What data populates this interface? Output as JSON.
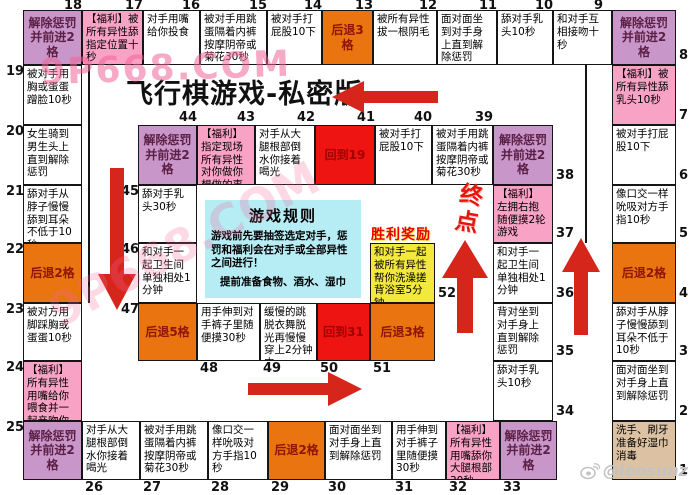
{
  "title": "飞行棋游戏-私密版",
  "labels": {
    "victory_header": "胜利奖励",
    "finish": "终点"
  },
  "rules": {
    "title": "游戏规则",
    "line1": "游戏前先要抽签选定对手，惩罚和福利会在对手或全部异性之间进行！",
    "line2": "提前准备食物、酒水、湿巾"
  },
  "watermarks": {
    "top": "9P668.COM",
    "diagonal": "9P668.COM",
    "credit": "@leosunz"
  },
  "colors": {
    "white": "#ffffff",
    "pink": "#f8a2c5",
    "purple": "#c996c9",
    "orange": "#e97410",
    "red": "#ee1411",
    "yellow": "#f3e93e",
    "tan": "#dcc2a2",
    "purple_text": "#5c2046",
    "orange_text": "#8f1500",
    "red_text": "#a30000",
    "black_text": "#000000",
    "border": "#151515",
    "rules_bg": "#b6ecf4",
    "arrow": "#d6261b",
    "victory_text": "#e60000",
    "finish_text": "#e8150f",
    "watermark_pink": "rgba(240,100,150,0.55)",
    "credit_gray": "#c3c3c3"
  },
  "board": {
    "cells": [
      {
        "num": 1,
        "text": "洗手、刷牙准备好湿巾消毒",
        "color": "tan",
        "x": 612,
        "y": 421,
        "w": 64,
        "h": 59,
        "numpos": "right"
      },
      {
        "num": 2,
        "text": "面对面坐到对手身上直到解除惩罚",
        "color": "white",
        "x": 612,
        "y": 361,
        "w": 64,
        "h": 60,
        "numpos": "right"
      },
      {
        "num": 3,
        "text": "舔对手从脖子慢慢舔到耳朵不低于10秒",
        "color": "white",
        "x": 612,
        "y": 303,
        "w": 64,
        "h": 58,
        "numpos": "right"
      },
      {
        "num": 4,
        "text": "后退2格",
        "color": "orange",
        "x": 612,
        "y": 243,
        "w": 64,
        "h": 60,
        "numpos": "right"
      },
      {
        "num": 5,
        "text": "像口交一样吮吸对方手指10秒",
        "color": "white",
        "x": 612,
        "y": 185,
        "w": 64,
        "h": 58,
        "numpos": "right"
      },
      {
        "num": 6,
        "text": "被对手打屁股10下",
        "color": "white",
        "x": 612,
        "y": 125,
        "w": 64,
        "h": 60,
        "numpos": "right"
      },
      {
        "num": 7,
        "text": "【福利】被所有异性舔乳头10秒",
        "color": "pink",
        "x": 612,
        "y": 65,
        "w": 64,
        "h": 60,
        "numpos": "right"
      },
      {
        "num": 8,
        "text": "解除惩罚并前进2格",
        "color": "purple",
        "x": 612,
        "y": 10,
        "w": 64,
        "h": 55,
        "numpos": "right"
      },
      {
        "num": 9,
        "text": "和对手互相接吻十秒",
        "color": "white",
        "x": 553,
        "y": 10,
        "w": 59,
        "h": 55,
        "numpos": "top"
      },
      {
        "num": 10,
        "text": "舔对手乳头10秒",
        "color": "white",
        "x": 497,
        "y": 10,
        "w": 56,
        "h": 55,
        "numpos": "top"
      },
      {
        "num": 11,
        "text": "面对面坐到对手身上直到解除惩罚",
        "color": "white",
        "x": 437,
        "y": 10,
        "w": 60,
        "h": 55,
        "numpos": "top"
      },
      {
        "num": 12,
        "text": "被所有异性拔一根阴毛",
        "color": "white",
        "x": 373,
        "y": 10,
        "w": 64,
        "h": 55,
        "numpos": "top"
      },
      {
        "num": 13,
        "text": "后退3格",
        "color": "orange",
        "x": 322,
        "y": 10,
        "w": 51,
        "h": 55,
        "numpos": "top"
      },
      {
        "num": 14,
        "text": "被对手打屁股10下",
        "color": "white",
        "x": 267,
        "y": 10,
        "w": 55,
        "h": 55,
        "numpos": "top"
      },
      {
        "num": 15,
        "text": "被对手用跳蛋隔着内裤按摩阴帝或菊花30秒",
        "color": "white",
        "x": 200,
        "y": 10,
        "w": 67,
        "h": 55,
        "numpos": "top"
      },
      {
        "num": 16,
        "text": "对手用嘴给你投食",
        "color": "white",
        "x": 143,
        "y": 10,
        "w": 57,
        "h": 55,
        "numpos": "top"
      },
      {
        "num": 17,
        "text": "【福利】被所有异性舔指定位置十秒",
        "color": "pink",
        "x": 82,
        "y": 10,
        "w": 61,
        "h": 55,
        "numpos": "top"
      },
      {
        "num": 18,
        "text": "解除惩罚并前进2格",
        "color": "purple",
        "x": 23,
        "y": 10,
        "w": 59,
        "h": 55,
        "numpos": "top"
      },
      {
        "num": 19,
        "text": "被对手用胸或蛋蛋蹭脸10秒",
        "color": "white",
        "x": 23,
        "y": 65,
        "w": 59,
        "h": 60,
        "numpos": "left"
      },
      {
        "num": 20,
        "text": "女生骑到男生头上直到解除惩罚",
        "color": "white",
        "x": 23,
        "y": 125,
        "w": 59,
        "h": 60,
        "numpos": "left"
      },
      {
        "num": 21,
        "text": "舔对手从脖子慢慢舔到耳朵不低于10秒",
        "color": "white",
        "x": 23,
        "y": 185,
        "w": 59,
        "h": 58,
        "numpos": "left"
      },
      {
        "num": 22,
        "text": "后退2格",
        "color": "orange",
        "x": 23,
        "y": 243,
        "w": 59,
        "h": 60,
        "numpos": "left"
      },
      {
        "num": 23,
        "text": "被对方用脚踩胸或蛋蛋10秒",
        "color": "white",
        "x": 23,
        "y": 303,
        "w": 59,
        "h": 58,
        "numpos": "left"
      },
      {
        "num": 24,
        "text": "【福利】所有异性用嘴给你喂食并一起亲吻你",
        "color": "pink",
        "x": 23,
        "y": 361,
        "w": 59,
        "h": 60,
        "numpos": "left"
      },
      {
        "num": 25,
        "text": "解除惩罚并前进2格",
        "color": "purple",
        "x": 23,
        "y": 421,
        "w": 59,
        "h": 59,
        "numpos": "left"
      },
      {
        "num": 26,
        "text": "对手从大腿根部倒水你接着喝光",
        "color": "white",
        "x": 82,
        "y": 421,
        "w": 58,
        "h": 59,
        "numpos": "bottom"
      },
      {
        "num": 27,
        "text": "被对手用跳蛋隔着内裤按摩阴帝或菊花30秒",
        "color": "white",
        "x": 140,
        "y": 421,
        "w": 68,
        "h": 59,
        "numpos": "bottom"
      },
      {
        "num": 28,
        "text": "像口交一样吮吸对方手指10秒",
        "color": "white",
        "x": 208,
        "y": 421,
        "w": 60,
        "h": 59,
        "numpos": "bottom"
      },
      {
        "num": 29,
        "text": "后退2格",
        "color": "orange",
        "x": 268,
        "y": 421,
        "w": 57,
        "h": 59,
        "numpos": "bottom"
      },
      {
        "num": 30,
        "text": "面对面坐到对手身上直到解除惩罚",
        "color": "white",
        "x": 325,
        "y": 421,
        "w": 67,
        "h": 59,
        "numpos": "bottom"
      },
      {
        "num": 31,
        "text": "用手伸到对手裤子里随便摸30秒",
        "color": "white",
        "x": 392,
        "y": 421,
        "w": 54,
        "h": 59,
        "numpos": "bottom"
      },
      {
        "num": 32,
        "text": "【福利】所有异性用嘴舔你大腿根部30秒",
        "color": "pink",
        "x": 446,
        "y": 421,
        "w": 54,
        "h": 59,
        "numpos": "bottom"
      },
      {
        "num": 33,
        "text": "解除惩罚并前进2格",
        "color": "purple",
        "x": 500,
        "y": 421,
        "w": 57,
        "h": 59,
        "numpos": "bottom"
      },
      {
        "num": 34,
        "text": "舔对手乳头10秒",
        "color": "white",
        "x": 493,
        "y": 361,
        "w": 60,
        "h": 60,
        "numpos": "right"
      },
      {
        "num": 35,
        "text": "背对坐到对手身上直到解除惩罚",
        "color": "white",
        "x": 493,
        "y": 303,
        "w": 60,
        "h": 58,
        "numpos": "right"
      },
      {
        "num": 36,
        "text": "和对手一起卫生间单独相处1分钟",
        "color": "white",
        "x": 493,
        "y": 243,
        "w": 60,
        "h": 60,
        "numpos": "right"
      },
      {
        "num": 37,
        "text": "【福利】左拥右抱随便摸2轮游戏",
        "color": "pink",
        "x": 493,
        "y": 185,
        "w": 60,
        "h": 58,
        "numpos": "right"
      },
      {
        "num": 38,
        "text": "解除惩罚并前进2格",
        "color": "purple",
        "x": 493,
        "y": 125,
        "w": 60,
        "h": 60,
        "numpos": "right"
      },
      {
        "num": 39,
        "text": "被对手用跳蛋隔着内裤按摩阴帝或菊花30秒",
        "color": "white",
        "x": 432,
        "y": 125,
        "w": 61,
        "h": 60,
        "numpos": "top"
      },
      {
        "num": 40,
        "text": "被对手打屁股10下",
        "color": "white",
        "x": 375,
        "y": 125,
        "w": 57,
        "h": 60,
        "numpos": "top"
      },
      {
        "num": 41,
        "text": "回到19",
        "color": "red",
        "x": 315,
        "y": 125,
        "w": 60,
        "h": 60,
        "numpos": "top"
      },
      {
        "num": 42,
        "text": "对手从大腿根部倒水你接着喝光",
        "color": "white",
        "x": 255,
        "y": 125,
        "w": 60,
        "h": 60,
        "numpos": "top"
      },
      {
        "num": 43,
        "text": "【福利】指定现场所有异性对你做你想做的事",
        "color": "pink",
        "x": 197,
        "y": 125,
        "w": 58,
        "h": 60,
        "numpos": "top"
      },
      {
        "num": 44,
        "text": "解除惩罚并前进2格",
        "color": "purple",
        "x": 138,
        "y": 125,
        "w": 59,
        "h": 60,
        "numpos": "top"
      },
      {
        "num": 45,
        "text": "舔对手乳头30秒",
        "color": "white",
        "x": 138,
        "y": 185,
        "w": 59,
        "h": 58,
        "numpos": "left"
      },
      {
        "num": 46,
        "text": "和对手一起卫生间单独相处1分钟",
        "color": "white",
        "x": 138,
        "y": 243,
        "w": 59,
        "h": 60,
        "numpos": "left"
      },
      {
        "num": 47,
        "text": "后退5格",
        "color": "orange",
        "x": 138,
        "y": 303,
        "w": 59,
        "h": 58,
        "numpos": "left"
      },
      {
        "num": 48,
        "text": "用手伸到对手裤子里随便摸30秒",
        "color": "white",
        "x": 197,
        "y": 303,
        "w": 63,
        "h": 58,
        "numpos": "bottom"
      },
      {
        "num": 49,
        "text": "缓慢的跳脱衣舞脱光再慢慢穿上2分钟内",
        "color": "white",
        "x": 260,
        "y": 303,
        "w": 57,
        "h": 58,
        "numpos": "bottom"
      },
      {
        "num": 50,
        "text": "回到31",
        "color": "red",
        "x": 317,
        "y": 303,
        "w": 53,
        "h": 58,
        "numpos": "bottom"
      },
      {
        "num": 51,
        "text": "后退3格",
        "color": "orange",
        "x": 370,
        "y": 303,
        "w": 65,
        "h": 58,
        "numpos": "bottom"
      },
      {
        "num": 52,
        "text": "和对手一起被所有异性帮你洗澡搓背浴室5分钟",
        "color": "yellow",
        "x": 370,
        "y": 243,
        "w": 65,
        "h": 60,
        "numpos": "right"
      }
    ]
  }
}
